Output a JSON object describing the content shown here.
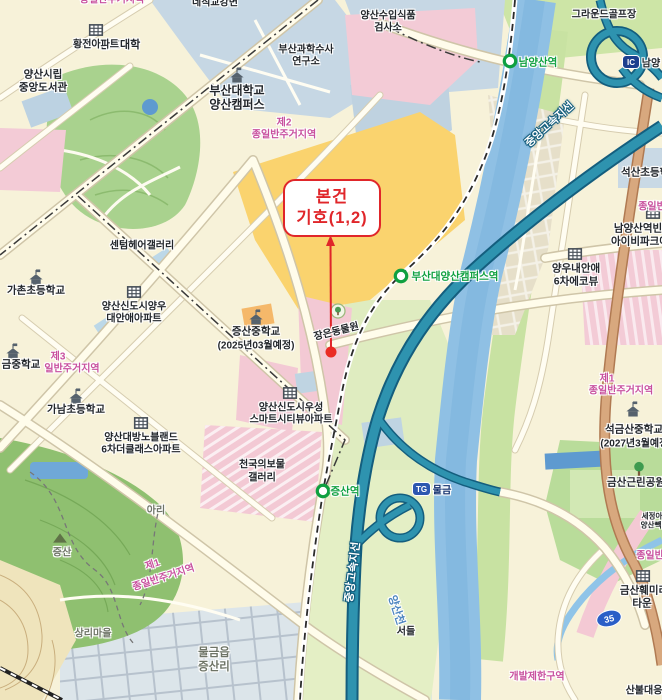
{
  "annotation": {
    "line1": "본건",
    "line2": "기호(1,2)"
  },
  "badges": {
    "ic": "IC",
    "ic_name": "남양",
    "tg": "TG",
    "tg_name": "물금",
    "route_shield": "35"
  },
  "colors": {
    "red_annotation": "#E0262A",
    "zone_pink": "#C8509E",
    "station_green": "#0FA040",
    "highway_teal": "#2E93AF",
    "highway_casing": "#145E7E",
    "river_blue": "#8FC0E4",
    "road_tan": "#D8A87E",
    "ic_badge_navy": "#1C3F8E",
    "tg_badge_blue": "#2C57B0",
    "shield_blue": "#2B5FC7"
  },
  "stations": [
    {
      "name": "남양산역",
      "x": 538,
      "y": 62
    },
    {
      "name": "부산대양산캠퍼스역",
      "x": 455,
      "y": 276
    },
    {
      "name": "증산역",
      "x": 345,
      "y": 491
    }
  ],
  "labels": [
    {
      "t": "간호대학",
      "x": 120,
      "y": 44,
      "s": 11
    },
    {
      "t": "부산대학교",
      "x": 237,
      "y": 90,
      "s": 12
    },
    {
      "t": "양산캠퍼스",
      "x": 237,
      "y": 104,
      "s": 12
    },
    {
      "t": "부산과학수사",
      "x": 306,
      "y": 48,
      "s": 10
    },
    {
      "t": "연구소",
      "x": 306,
      "y": 60,
      "s": 10
    },
    {
      "t": "양산수입식품",
      "x": 388,
      "y": 14,
      "s": 10
    },
    {
      "t": "검사소",
      "x": 388,
      "y": 26,
      "s": 10
    },
    {
      "t": "그라운드골프장",
      "x": 604,
      "y": 13,
      "s": 10
    },
    {
      "t": "네직교강변",
      "x": 215,
      "y": 1,
      "s": 10
    },
    {
      "t": "황전아파트",
      "x": 96,
      "y": 43,
      "s": 10
    },
    {
      "t": "양산시립",
      "x": 43,
      "y": 74,
      "s": 10.5
    },
    {
      "t": "중앙도서관",
      "x": 43,
      "y": 87,
      "s": 10.5
    },
    {
      "t": "종일반주거지역",
      "x": 112,
      "y": -2,
      "s": 10,
      "c": "zone"
    },
    {
      "t": "제2",
      "x": 284,
      "y": 121,
      "s": 10,
      "c": "zone"
    },
    {
      "t": "종일반주거지역",
      "x": 284,
      "y": 133,
      "s": 10,
      "c": "zone"
    },
    {
      "t": "센텀헤어갤러리",
      "x": 142,
      "y": 244,
      "s": 10
    },
    {
      "t": "가촌초등학교",
      "x": 36,
      "y": 290,
      "s": 10.5
    },
    {
      "t": "양산신도시양우",
      "x": 134,
      "y": 305,
      "s": 10
    },
    {
      "t": "대안애아파트",
      "x": 134,
      "y": 317,
      "s": 10
    },
    {
      "t": "증산중학교",
      "x": 256,
      "y": 331,
      "s": 10.5
    },
    {
      "t": "(2025년03월예정)",
      "x": 256,
      "y": 344,
      "s": 10
    },
    {
      "t": "제3",
      "x": 58,
      "y": 355,
      "s": 10,
      "c": "zone"
    },
    {
      "t": "일반주거지역",
      "x": 72,
      "y": 367,
      "s": 10,
      "c": "zone"
    },
    {
      "t": "금중학교",
      "x": 21,
      "y": 364,
      "s": 10.5
    },
    {
      "t": "가남초등학교",
      "x": 76,
      "y": 409,
      "s": 10.5
    },
    {
      "t": "양산대방노블랜드",
      "x": 141,
      "y": 436,
      "s": 10
    },
    {
      "t": "6차더클래스아파트",
      "x": 141,
      "y": 448,
      "s": 10
    },
    {
      "t": "양산신도시우성",
      "x": 291,
      "y": 406,
      "s": 10
    },
    {
      "t": "스마트시티뷰아파트",
      "x": 291,
      "y": 418,
      "s": 10
    },
    {
      "t": "천국의보물",
      "x": 262,
      "y": 463,
      "s": 10
    },
    {
      "t": "갤러리",
      "x": 262,
      "y": 476,
      "s": 10
    },
    {
      "t": "장은동물원",
      "x": 336,
      "y": 330,
      "s": 10,
      "r": -14
    },
    {
      "t": "증산",
      "x": 62,
      "y": 551,
      "s": 10,
      "c": "grey"
    },
    {
      "t": "아리",
      "x": 156,
      "y": 509,
      "s": 10,
      "c": "grey"
    },
    {
      "t": "상리마을",
      "x": 93,
      "y": 632,
      "s": 10,
      "c": "grey"
    },
    {
      "t": "물금읍",
      "x": 214,
      "y": 652,
      "s": 11.5,
      "c": "grey"
    },
    {
      "t": "증산리",
      "x": 214,
      "y": 666,
      "s": 11.5,
      "c": "grey"
    },
    {
      "t": "서들",
      "x": 406,
      "y": 630,
      "s": 10
    },
    {
      "t": "제1",
      "x": 152,
      "y": 563,
      "s": 10,
      "c": "zone",
      "r": -18
    },
    {
      "t": "종일반주거지역",
      "x": 163,
      "y": 576,
      "s": 10,
      "c": "zone",
      "r": -18
    },
    {
      "t": "석산초등학교",
      "x": 650,
      "y": 172,
      "s": 10.5
    },
    {
      "t": "종일반",
      "x": 652,
      "y": 205,
      "s": 10,
      "c": "zone"
    },
    {
      "t": "남양산역빈",
      "x": 638,
      "y": 228,
      "s": 10.5
    },
    {
      "t": "아이비파크에",
      "x": 640,
      "y": 241,
      "s": 10.5
    },
    {
      "t": "양우내안애",
      "x": 576,
      "y": 268,
      "s": 10.5
    },
    {
      "t": "6차에코뷰",
      "x": 576,
      "y": 281,
      "s": 10.5
    },
    {
      "t": "제1",
      "x": 607,
      "y": 377,
      "s": 10,
      "c": "zone"
    },
    {
      "t": "종일반주거지역",
      "x": 621,
      "y": 389,
      "s": 10,
      "c": "zone"
    },
    {
      "t": "석금산중학교",
      "x": 634,
      "y": 429,
      "s": 10.5
    },
    {
      "t": "(2027년3월예정)",
      "x": 636,
      "y": 442,
      "s": 10
    },
    {
      "t": "금산근린공원",
      "x": 636,
      "y": 482,
      "s": 10.5
    },
    {
      "t": "세정아",
      "x": 652,
      "y": 516,
      "s": 7.5
    },
    {
      "t": "양산빽",
      "x": 651,
      "y": 525,
      "s": 7.5
    },
    {
      "t": "종일반",
      "x": 650,
      "y": 554,
      "s": 10,
      "c": "zone"
    },
    {
      "t": "금산훼미리",
      "x": 644,
      "y": 590,
      "s": 10.5
    },
    {
      "t": "타운",
      "x": 642,
      "y": 603,
      "s": 10.5
    },
    {
      "t": "개발제한구역",
      "x": 537,
      "y": 675,
      "s": 10,
      "c": "zone"
    },
    {
      "t": "산불대응",
      "x": 644,
      "y": 689,
      "s": 10
    },
    {
      "t": "중앙고속지선",
      "x": 549,
      "y": 124,
      "s": 11,
      "c": "road-name",
      "r": -42
    },
    {
      "t": "중앙고속지선",
      "x": 352,
      "y": 572,
      "s": 11,
      "c": "road-name",
      "r": -83
    },
    {
      "t": "양산천",
      "x": 397,
      "y": 610,
      "s": 11,
      "c": "water",
      "r": 72
    },
    {
      "t": "물금",
      "x": 442,
      "y": 489,
      "s": 10,
      "c": "navy"
    },
    {
      "t": "남양",
      "x": 651,
      "y": 62,
      "s": 10
    }
  ],
  "icons": [
    {
      "type": "school",
      "x": 36,
      "y": 277
    },
    {
      "type": "school",
      "x": 256,
      "y": 317
    },
    {
      "type": "school",
      "x": 76,
      "y": 396
    },
    {
      "type": "school",
      "x": 13,
      "y": 351
    },
    {
      "type": "school",
      "x": 633,
      "y": 409
    },
    {
      "type": "school",
      "x": 237,
      "y": 75
    },
    {
      "type": "apartment",
      "x": 96,
      "y": 30
    },
    {
      "type": "apartment",
      "x": 134,
      "y": 292
    },
    {
      "type": "apartment",
      "x": 141,
      "y": 423
    },
    {
      "type": "apartment",
      "x": 290,
      "y": 393
    },
    {
      "type": "apartment",
      "x": 575,
      "y": 254
    },
    {
      "type": "apartment",
      "x": 653,
      "y": 213
    },
    {
      "type": "apartment",
      "x": 643,
      "y": 576
    },
    {
      "type": "tree",
      "x": 639,
      "y": 469
    },
    {
      "type": "peak",
      "x": 60,
      "y": 538
    },
    {
      "type": "poi-tree",
      "x": 338,
      "y": 311
    },
    {
      "type": "station",
      "x": 510,
      "y": 61
    },
    {
      "type": "station",
      "x": 401,
      "y": 276
    },
    {
      "type": "station",
      "x": 323,
      "y": 491
    }
  ]
}
